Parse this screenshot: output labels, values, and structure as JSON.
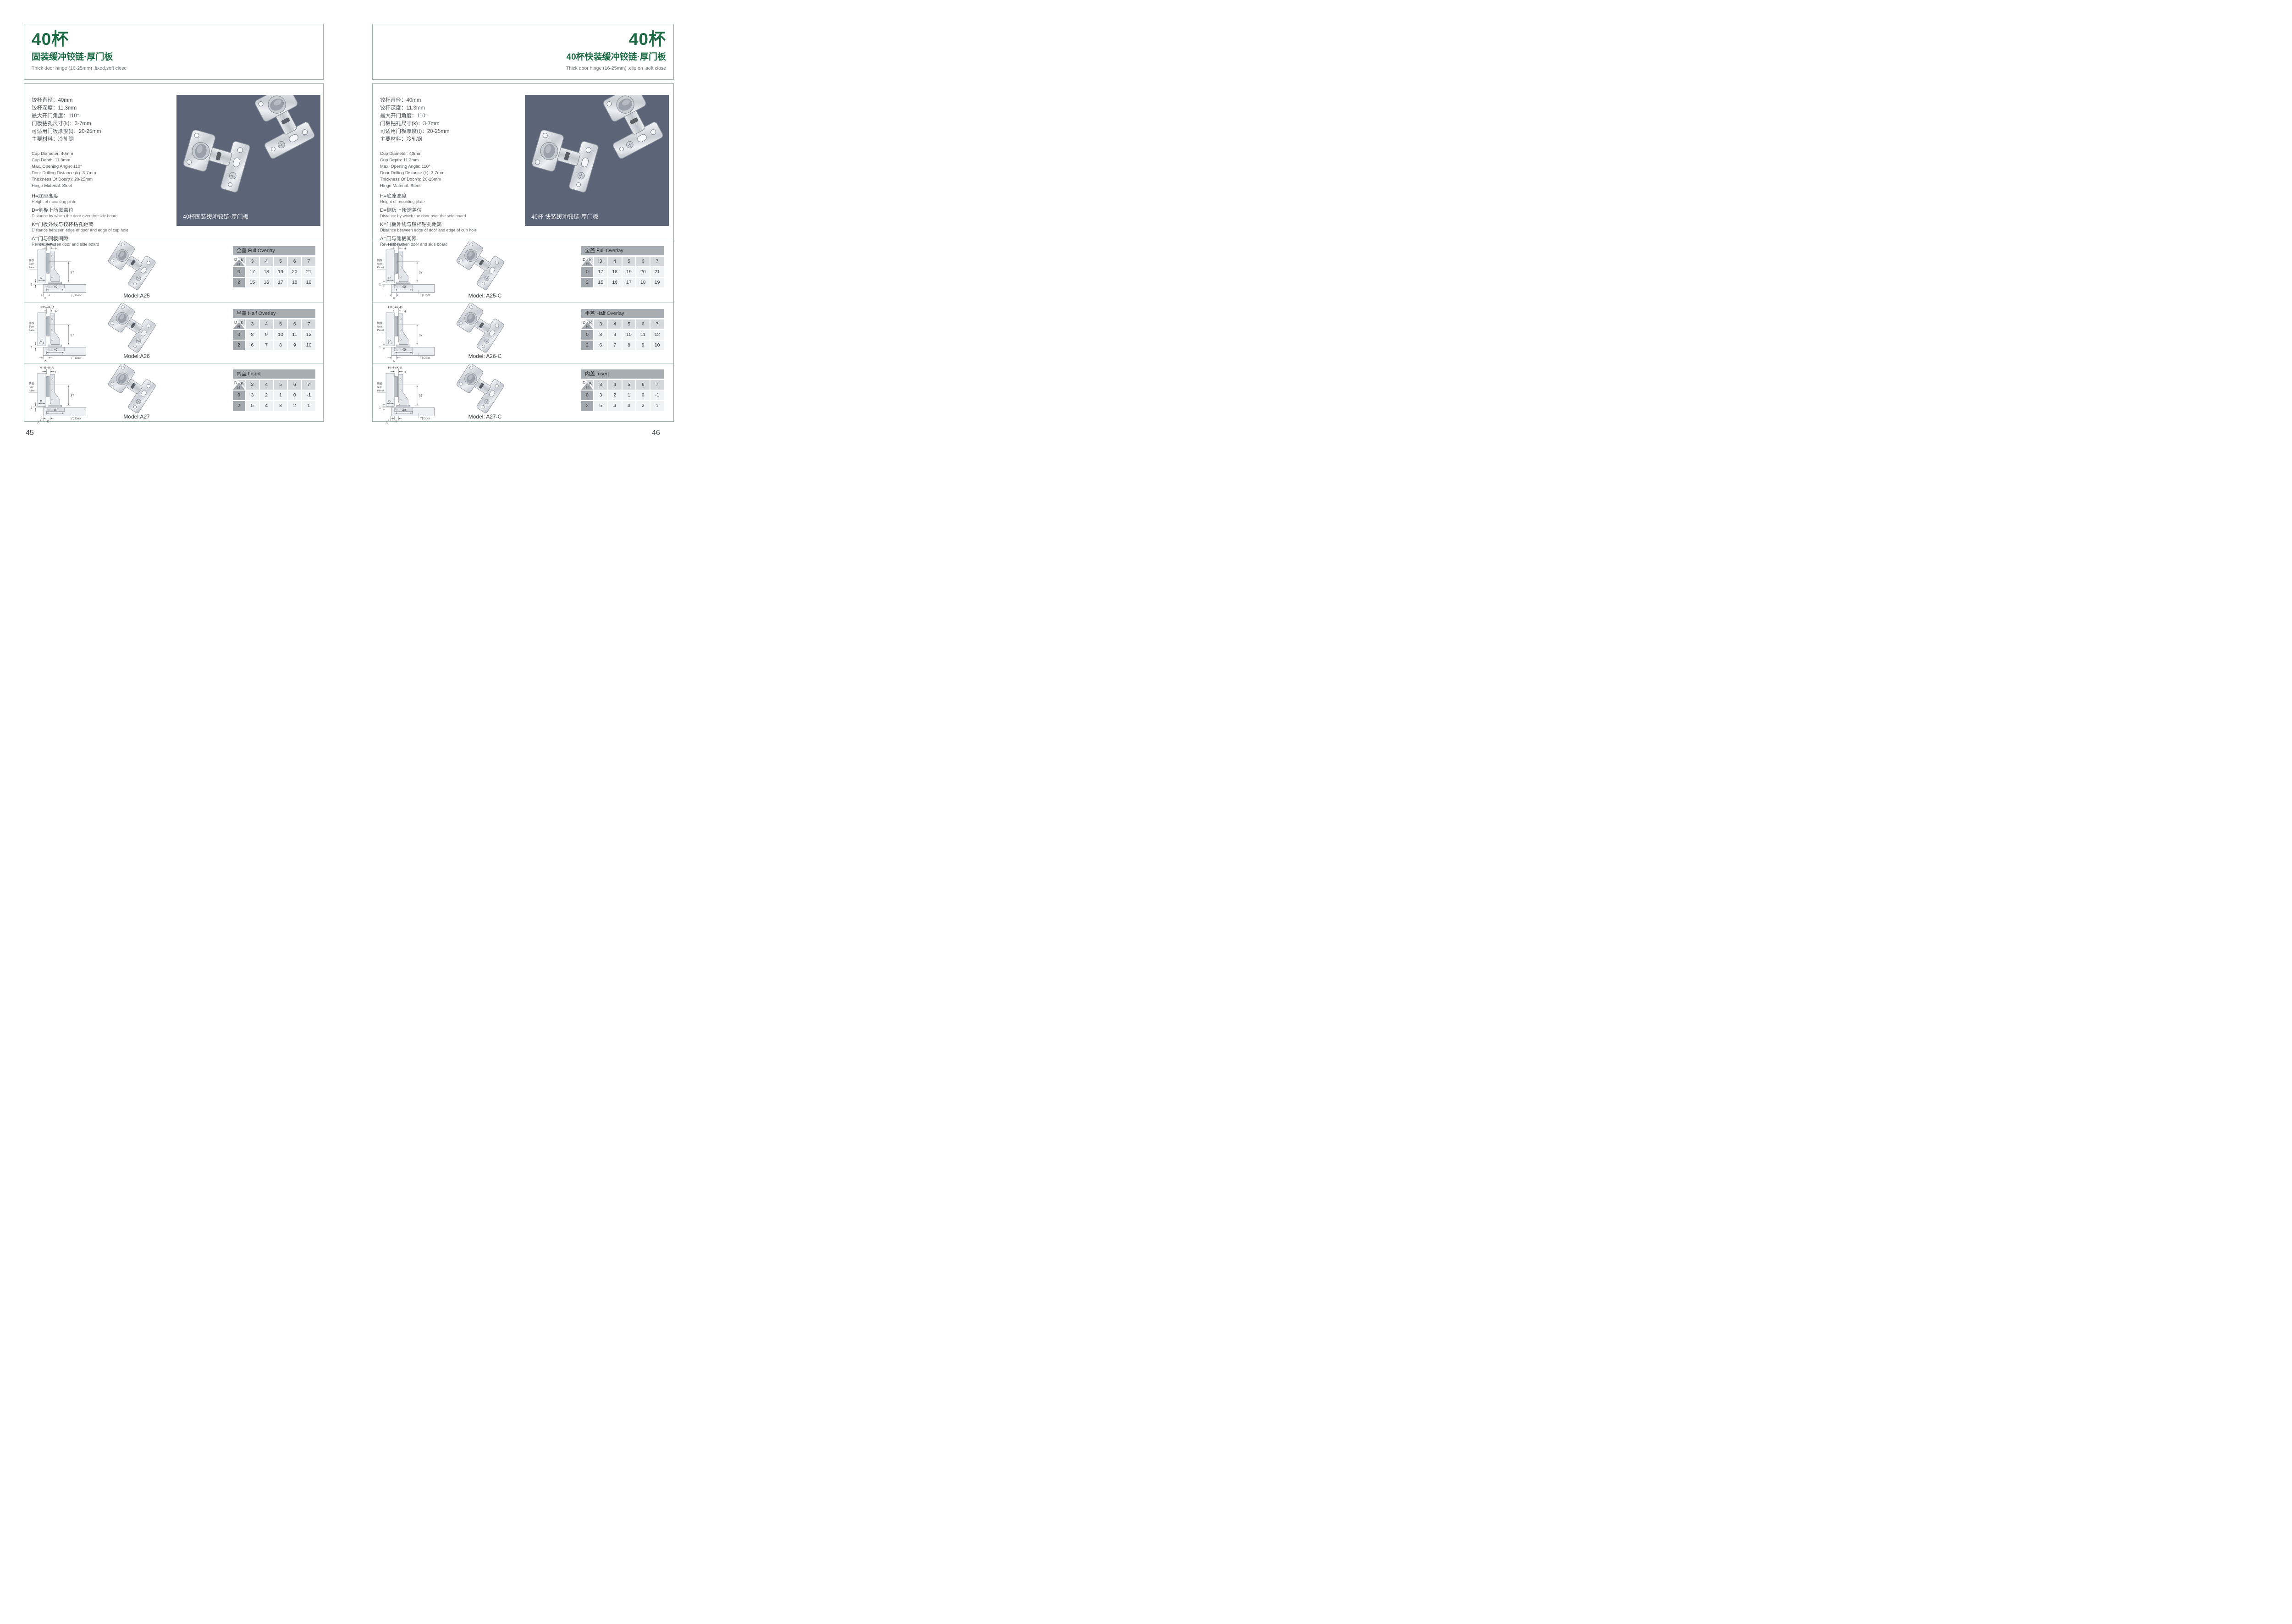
{
  "colors": {
    "green": "#1d6a45",
    "photo_bg": "#5c6478",
    "border": "#9bb3a6",
    "divider": "#aecabb"
  },
  "diagram": {
    "side_panel": [
      "侧板",
      "Side",
      "Panel"
    ],
    "door": "门 Door",
    "dims": {
      "d37": "37",
      "d40": "40",
      "d1": "1"
    },
    "labels": {
      "H": "H",
      "D": "D",
      "K": "K",
      "A": "A"
    }
  },
  "table_corner": {
    "d": "D",
    "k": "K",
    "h": "H"
  },
  "pages": [
    {
      "page_number": "45",
      "title": "40杯",
      "subtitle": "固装缓冲铰链·厚门板",
      "subtitle_en": "Thick door hinge (16-25mm)  ,fixed,soft close",
      "specs_cn": [
        "铰杯直径：40mm",
        "铰杯深度：11.3mm",
        "最大开门角度：110°",
        "门板钻孔尺寸(k)：3-7mm",
        "可适用门板厚度(t)：20-25mm",
        "主要材料：冷轧钢"
      ],
      "specs_en": [
        "Cup Diameter: 40mm",
        "Cup Depth: 11.3mm",
        "Max. Opening Angle: 110°",
        "Door Drilling Distance (k): 3-7mm",
        "Thickness Of Door(t): 20-25mm",
        "Hinge Material: Steel"
      ],
      "definitions": [
        {
          "term": "H=底座高度",
          "desc": "Height of mounting plate"
        },
        {
          "term": "D=侧板上所需盖位",
          "desc": "Distance by which the door over the side board"
        },
        {
          "term": "K=门板外线与铰杯钻孔距离",
          "desc": "Distance between edge of door and edge of cup hole"
        },
        {
          "term": "A=门与侧板间隙",
          "desc": "Reveal between door and side board"
        }
      ],
      "photo_caption": "40杯固装缓冲铰链·厚门板",
      "rows": [
        {
          "formula": "H=14+K-D",
          "has_a": false,
          "model": "Model:A25",
          "table": {
            "title": "全盖 Full Overlay",
            "k": [
              "3",
              "4",
              "5",
              "6",
              "7"
            ],
            "body": [
              [
                "0",
                "17",
                "18",
                "19",
                "20",
                "21"
              ],
              [
                "2",
                "15",
                "16",
                "17",
                "18",
                "19"
              ]
            ]
          }
        },
        {
          "formula": "H=5+K-D",
          "has_a": false,
          "model": "Model:A26",
          "table": {
            "title": "半盖 Half Overlay",
            "k": [
              "3",
              "4",
              "5",
              "6",
              "7"
            ],
            "body": [
              [
                "0",
                "8",
                "9",
                "10",
                "11",
                "12"
              ],
              [
                "2",
                "6",
                "7",
                "8",
                "9",
                "10"
              ]
            ]
          }
        },
        {
          "formula": "H=6+K-A",
          "has_a": true,
          "model": "Model:A27",
          "table": {
            "title": "内盖 Insert",
            "k": [
              "3",
              "4",
              "5",
              "6",
              "7"
            ],
            "body": [
              [
                "0",
                "3",
                "2",
                "1",
                "0",
                "-1"
              ],
              [
                "2",
                "5",
                "4",
                "3",
                "2",
                "1"
              ]
            ]
          }
        }
      ]
    },
    {
      "page_number": "46",
      "title": "40杯",
      "subtitle": "40杯快装缓冲铰链·厚门板",
      "subtitle_en": "Thick door hinge (16-25mm)  ,clip on ,soft close",
      "specs_cn": [
        "铰杯直径：40mm",
        "铰杯深度：11.3mm",
        "最大开门角度：110°",
        "门板钻孔尺寸(k)：3-7mm",
        "可适用门板厚度(t)：20-25mm",
        "主要材料：冷轧钢"
      ],
      "specs_en": [
        "Cup Diameter: 40mm",
        "Cup Depth: 11.3mm",
        "Max. Opening Angle: 110°",
        "Door Drilling Distance (k): 3-7mm",
        "Thickness Of Door(t): 20-25mm",
        "Hinge Material: Steel"
      ],
      "definitions": [
        {
          "term": "H=底座高度",
          "desc": "Height of mounting plate"
        },
        {
          "term": "D=侧板上所需盖位",
          "desc": "Distance by which the door over the side board"
        },
        {
          "term": "K=门板外线与铰杯钻孔距离",
          "desc": "Distance between edge of door and edge of cup hole"
        },
        {
          "term": "A=门与侧板间隙",
          "desc": "Reveal between door and side board"
        }
      ],
      "photo_caption": "40杯 快装缓冲铰链·厚门板",
      "rows": [
        {
          "formula": "H=14+K-D",
          "has_a": false,
          "model": "Model: A25-C",
          "table": {
            "title": "全盖 Full Overlay",
            "k": [
              "3",
              "4",
              "5",
              "6",
              "7"
            ],
            "body": [
              [
                "0",
                "17",
                "18",
                "19",
                "20",
                "21"
              ],
              [
                "2",
                "15",
                "16",
                "17",
                "18",
                "19"
              ]
            ]
          }
        },
        {
          "formula": "H=5+K-D",
          "has_a": false,
          "model": "Model: A26-C",
          "table": {
            "title": "半盖 Half Overlay",
            "k": [
              "3",
              "4",
              "5",
              "6",
              "7"
            ],
            "body": [
              [
                "0",
                "8",
                "9",
                "10",
                "11",
                "12"
              ],
              [
                "2",
                "6",
                "7",
                "8",
                "9",
                "10"
              ]
            ]
          }
        },
        {
          "formula": "H=6+K-A",
          "has_a": true,
          "model": "Model: A27-C",
          "table": {
            "title": "内盖 Insert",
            "k": [
              "3",
              "4",
              "5",
              "6",
              "7"
            ],
            "body": [
              [
                "0",
                "3",
                "2",
                "1",
                "0",
                "-1"
              ],
              [
                "2",
                "5",
                "4",
                "3",
                "2",
                "1"
              ]
            ]
          }
        }
      ]
    }
  ]
}
